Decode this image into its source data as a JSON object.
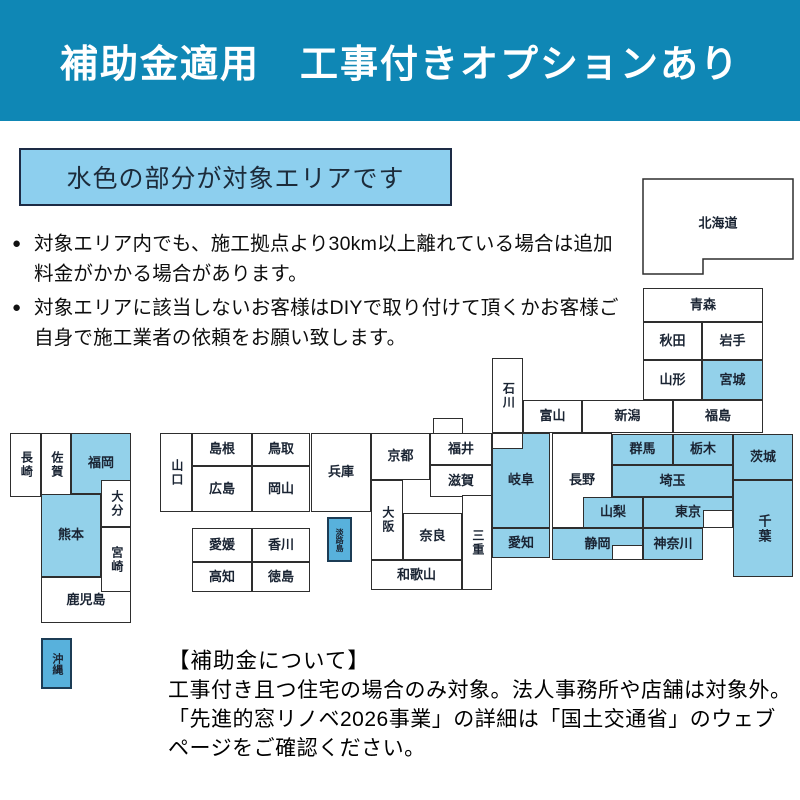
{
  "colors": {
    "header_bg": "#0f87b5",
    "area_fill": "#93d1ea",
    "island_fill": "#58b1dc",
    "map_border": "#2e2e2e",
    "banner_fill": "#8dcfee",
    "banner_border": "#1d2b45",
    "label": "#1a2433"
  },
  "header": {
    "title": "補助金適用　工事付きオプションあり"
  },
  "area_banner": {
    "label": "水色の部分が対象エリアです"
  },
  "notes": [
    "対象エリア内でも、施工拠点より30km以上離れている場合は追加料金がかかる場合があります。",
    "対象エリアに該当しないお客様はDIYで取り付けて頂くかお客様ご自身で施工業者の依頼をお願い致します。"
  ],
  "footer": {
    "heading": "【補助金について】",
    "lines": [
      "工事付き且つ住宅の場合のみ対象。法人事務所や店舗は対象外。",
      "「先進的窓リノベ2026事業」の詳細は「国土交通省」のウェブ",
      "ページをご確認ください。"
    ]
  },
  "map": {
    "highlight_meaning": "対象エリア（水色）",
    "prefectures": [
      {
        "id": "hokkaido",
        "label": "北海道",
        "x": 642,
        "y": 178,
        "w": 153,
        "h": 98,
        "points": "1,1 151,1 151,81 61,81 61,96 1,96",
        "lx": 76,
        "ly": 46,
        "hl": false
      },
      {
        "id": "aomori",
        "label": "青森",
        "x": 643,
        "y": 288,
        "w": 120,
        "h": 34,
        "hl": false
      },
      {
        "id": "akita",
        "label": "秋田",
        "x": 643,
        "y": 322,
        "w": 59,
        "h": 38,
        "hl": false
      },
      {
        "id": "iwate",
        "label": "岩手",
        "x": 702,
        "y": 322,
        "w": 61,
        "h": 38,
        "hl": false
      },
      {
        "id": "yamagata",
        "label": "山形",
        "x": 643,
        "y": 360,
        "w": 59,
        "h": 40,
        "hl": false
      },
      {
        "id": "miyagi",
        "label": "宮城",
        "x": 702,
        "y": 360,
        "w": 61,
        "h": 40,
        "hl": true
      },
      {
        "id": "niigata",
        "label": "新潟",
        "x": 582,
        "y": 400,
        "w": 91,
        "h": 33,
        "hl": false
      },
      {
        "id": "fukushima",
        "label": "福島",
        "x": 673,
        "y": 400,
        "w": 90,
        "h": 33,
        "hl": false
      },
      {
        "id": "toyama",
        "label": "富山",
        "x": 523,
        "y": 400,
        "w": 59,
        "h": 33,
        "hl": false
      },
      {
        "id": "ishikawa",
        "label": "石川",
        "x": 492,
        "y": 358,
        "w": 31,
        "h": 75,
        "vert": true,
        "fs": 12,
        "hl": false
      },
      {
        "id": "fukui-bump",
        "label": "",
        "x": 433,
        "y": 418,
        "w": 30,
        "h": 16,
        "hl": false
      },
      {
        "id": "fukui",
        "label": "福井",
        "x": 430,
        "y": 433,
        "w": 62,
        "h": 32,
        "hl": false
      },
      {
        "id": "shiga",
        "label": "滋賀",
        "x": 430,
        "y": 465,
        "w": 62,
        "h": 32,
        "hl": false
      },
      {
        "id": "kyoto",
        "label": "京都",
        "x": 371,
        "y": 433,
        "w": 59,
        "h": 47,
        "hl": false
      },
      {
        "id": "hyogo",
        "label": "兵庫",
        "x": 311,
        "y": 433,
        "w": 60,
        "h": 79,
        "hl": false
      },
      {
        "id": "osaka",
        "label": "大阪",
        "x": 371,
        "y": 480,
        "w": 32,
        "h": 80,
        "vert": true,
        "fs": 12,
        "hl": false
      },
      {
        "id": "nara",
        "label": "奈良",
        "x": 403,
        "y": 513,
        "w": 59,
        "h": 47,
        "hl": false
      },
      {
        "id": "mie",
        "label": "三重",
        "x": 462,
        "y": 495,
        "w": 30,
        "h": 95,
        "vert": true,
        "fs": 12,
        "hl": false
      },
      {
        "id": "wakayama",
        "label": "和歌山",
        "x": 371,
        "y": 560,
        "w": 91,
        "h": 30,
        "hl": false
      },
      {
        "id": "awaji",
        "label": "淡路島",
        "x": 327,
        "y": 517,
        "w": 25,
        "h": 45,
        "vert": true,
        "fs": 8,
        "island": true,
        "over": true,
        "hl": true
      },
      {
        "id": "gifu",
        "label": "岐阜",
        "x": 492,
        "y": 433,
        "w": 58,
        "h": 95,
        "hl": true
      },
      {
        "id": "gifu-notch",
        "label": "",
        "x": 492,
        "y": 433,
        "w": 31,
        "h": 16,
        "over": true,
        "hl": false
      },
      {
        "id": "aichi",
        "label": "愛知",
        "x": 492,
        "y": 528,
        "w": 58,
        "h": 30,
        "hl": true
      },
      {
        "id": "nagano",
        "label": "長野",
        "x": 552,
        "y": 433,
        "w": 60,
        "h": 95,
        "hl": false
      },
      {
        "id": "yamanashi",
        "label": "山梨",
        "x": 583,
        "y": 497,
        "w": 60,
        "h": 31,
        "over": true,
        "hl": true
      },
      {
        "id": "shizuoka",
        "label": "静岡",
        "x": 552,
        "y": 528,
        "w": 91,
        "h": 32,
        "hl": true
      },
      {
        "id": "shizuoka-notch",
        "label": "",
        "x": 612,
        "y": 545,
        "w": 31,
        "h": 15,
        "over": true,
        "hl": false
      },
      {
        "id": "gunma",
        "label": "群馬",
        "x": 612,
        "y": 434,
        "w": 61,
        "h": 31,
        "hl": true
      },
      {
        "id": "tochigi",
        "label": "栃木",
        "x": 673,
        "y": 434,
        "w": 60,
        "h": 31,
        "hl": true
      },
      {
        "id": "saitama",
        "label": "埼玉",
        "x": 612,
        "y": 465,
        "w": 121,
        "h": 32,
        "hl": true
      },
      {
        "id": "ibaraki",
        "label": "茨城",
        "x": 733,
        "y": 434,
        "w": 60,
        "h": 46,
        "hl": true
      },
      {
        "id": "tokyo",
        "label": "東京",
        "x": 643,
        "y": 497,
        "w": 90,
        "h": 31,
        "hl": true
      },
      {
        "id": "tokyo-notch",
        "label": "",
        "x": 703,
        "y": 510,
        "w": 30,
        "h": 18,
        "over": true,
        "hl": false
      },
      {
        "id": "kanagawa",
        "label": "神奈川",
        "x": 643,
        "y": 528,
        "w": 60,
        "h": 32,
        "hl": true
      },
      {
        "id": "chiba",
        "label": "千葉",
        "x": 733,
        "y": 480,
        "w": 60,
        "h": 97,
        "vert": true,
        "hl": true
      },
      {
        "id": "yamaguchi",
        "label": "山口",
        "x": 160,
        "y": 433,
        "w": 32,
        "h": 79,
        "vert": true,
        "fs": 12,
        "hl": false
      },
      {
        "id": "shimane",
        "label": "島根",
        "x": 192,
        "y": 433,
        "w": 60,
        "h": 33,
        "hl": false
      },
      {
        "id": "tottori",
        "label": "鳥取",
        "x": 252,
        "y": 433,
        "w": 58,
        "h": 33,
        "hl": false
      },
      {
        "id": "hiroshima",
        "label": "広島",
        "x": 192,
        "y": 466,
        "w": 60,
        "h": 46,
        "hl": false
      },
      {
        "id": "okayama",
        "label": "岡山",
        "x": 252,
        "y": 466,
        "w": 58,
        "h": 46,
        "hl": false
      },
      {
        "id": "ehime",
        "label": "愛媛",
        "x": 192,
        "y": 528,
        "w": 60,
        "h": 34,
        "hl": false
      },
      {
        "id": "kagawa",
        "label": "香川",
        "x": 252,
        "y": 528,
        "w": 58,
        "h": 34,
        "hl": false
      },
      {
        "id": "kochi",
        "label": "高知",
        "x": 192,
        "y": 562,
        "w": 60,
        "h": 30,
        "hl": false
      },
      {
        "id": "tokushima",
        "label": "徳島",
        "x": 252,
        "y": 562,
        "w": 58,
        "h": 30,
        "hl": false
      },
      {
        "id": "nagasaki",
        "label": "長崎",
        "x": 10,
        "y": 433,
        "w": 31,
        "h": 64,
        "vert": true,
        "fs": 12,
        "hl": false
      },
      {
        "id": "saga",
        "label": "佐賀",
        "x": 41,
        "y": 433,
        "w": 30,
        "h": 64,
        "vert": true,
        "fs": 12,
        "hl": false
      },
      {
        "id": "fukuoka",
        "label": "福岡",
        "x": 71,
        "y": 433,
        "w": 60,
        "h": 61,
        "hl": true
      },
      {
        "id": "oita",
        "label": "大分",
        "x": 101,
        "y": 480,
        "w": 30,
        "h": 47,
        "vert": true,
        "fs": 12,
        "over": true,
        "hl": false
      },
      {
        "id": "kumamoto",
        "label": "熊本",
        "x": 41,
        "y": 494,
        "w": 60,
        "h": 83,
        "hl": true
      },
      {
        "id": "kagoshima",
        "label": "鹿児島",
        "x": 41,
        "y": 577,
        "w": 90,
        "h": 46,
        "hl": false
      },
      {
        "id": "miyazaki",
        "label": "宮崎",
        "x": 101,
        "y": 527,
        "w": 30,
        "h": 65,
        "vert": true,
        "fs": 12,
        "over": true,
        "hl": false
      },
      {
        "id": "okinawa",
        "label": "沖縄",
        "x": 41,
        "y": 638,
        "w": 31,
        "h": 51,
        "vert": true,
        "fs": 11,
        "island": true,
        "hl": true
      }
    ]
  }
}
